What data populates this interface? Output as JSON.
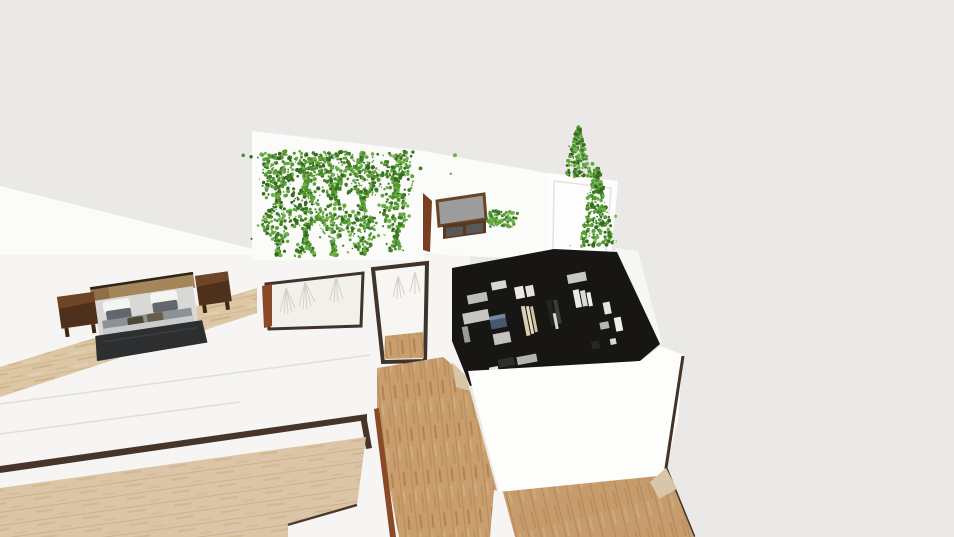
{
  "scene": {
    "type": "3d-interior-render",
    "description": "High-angle 3D render of an apartment: bedroom with double bed and nightstands, vine-covered wall, hallway doors, wall-mounted frame with console and plant, white panel with conical vine plants, dark walk-in closet filled with clothes, oak and pale wood floors",
    "colors": {
      "background": "#eae9e7",
      "wall": "#fbfbfa",
      "wall_dim": "#f6f5f3",
      "wall_bright": "#fdfdfc",
      "alcove_floor": "#f2f0ea",
      "trim": "#3f332a",
      "frame_bar": "#463528",
      "seam": "#e0dfdd",
      "door_wood": "#8a4a28",
      "wedge_wood": "#7a3f22",
      "wood_pale": "#dcc6a4",
      "wood_pale_streak": "#cdb48d",
      "wood_mid": "#c89e6e",
      "wood_mid_streak": "#b78c5b",
      "wood_threshold": "#d9c5a8",
      "closet_floor": "#181614",
      "foliage": [
        "#35691f",
        "#3e7a26",
        "#4f9230",
        "#5fa53c",
        "#6fb34a"
      ],
      "strand": "#d4d1c7",
      "headboard": "#a5855a",
      "headboard_shadow": "#8f7049",
      "mattress": "#d8d8d6",
      "pillow_white": "#f4f4f2",
      "pillow_gray": "#63666a",
      "blanket_gray": "#8e9194",
      "sheet_light": "#c9cbcd",
      "accent_pillow": "#4e4639",
      "accent_pillow2": "#6a5d48",
      "throw_dark": "#2c2e30",
      "nightstand": "#4f301b",
      "nightstand_top": "#6f4527",
      "nightstand_leg": "#3f2716",
      "tv_frame": "#6b4424",
      "tv_screen": "#9c9c9c",
      "console": "#59381e",
      "console_front": "#57585a",
      "blue_box": "#46586e",
      "blue_box_top": "#7388a0",
      "garment_cream": "#d9cfb6",
      "garment_cream2": "#e6debc",
      "garment_white": "#eceae6",
      "garment_dark": "#232321",
      "shelf_gray": "#c6c6c4",
      "shelf_gray_dim": "#b3b3b1"
    },
    "objects": [
      {
        "name": "bedroom",
        "items": [
          "double-bed",
          "nightstand-left",
          "nightstand-right",
          "pale-wood-floor"
        ]
      },
      {
        "name": "vine-wall",
        "items": [
          "climbing-vine x5"
        ]
      },
      {
        "name": "hallway",
        "items": [
          "door-frame",
          "alcove-with-hanging-strands",
          "open-door-wedge",
          "oak-floor"
        ]
      },
      {
        "name": "media-room",
        "items": [
          "framed-screen",
          "wall-console",
          "potted-plant",
          "white-panel",
          "cone-plant-small",
          "cone-plant-large"
        ]
      },
      {
        "name": "walk-in-closet",
        "items": [
          "dark-floor",
          "folded-clothes-stacks",
          "hanging-garments",
          "blue-storage-box"
        ]
      },
      {
        "name": "living-area",
        "items": [
          "glass-partition-frame",
          "pale-wood-floor",
          "oak-floor"
        ]
      }
    ]
  }
}
